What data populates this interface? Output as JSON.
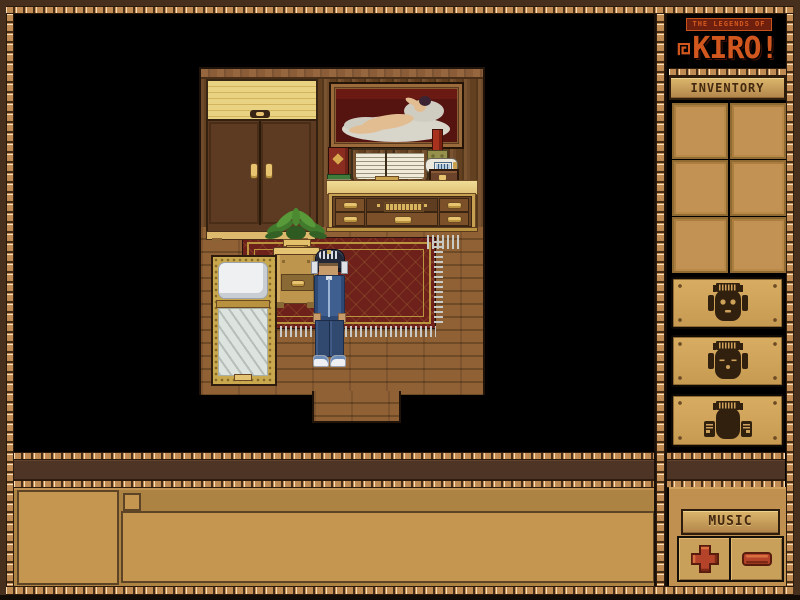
{
  "logo": {
    "tagline": "THE LEGENDS OF",
    "title": "KIRO!"
  },
  "inventory": {
    "header": "INVENTORY",
    "slot_count": 6,
    "slots": [
      "",
      "",
      "",
      "",
      "",
      ""
    ]
  },
  "emote_buttons": [
    {
      "icon": "tribal-mask-eyes-open-icon"
    },
    {
      "icon": "tribal-mask-eyes-closed-icon"
    },
    {
      "icon": "tribal-mask-fists-icon"
    }
  ],
  "music": {
    "label": "MUSIC",
    "volume_up_glyph": "plus",
    "volume_down_glyph": "minus"
  },
  "chat": {
    "portrait_value": "",
    "checkbox_checked": false,
    "input_value": ""
  },
  "scene": {
    "location": "bedroom",
    "objects": [
      "wardrobe",
      "framed-painting-reclining-figure",
      "dresser-desk",
      "open-book",
      "red-book",
      "book-stack",
      "red-candle",
      "bottle",
      "small-chest",
      "potted-fern",
      "bed",
      "nightstand",
      "red-rug",
      "doorway"
    ],
    "player": {
      "outfit": "blue tracksuit",
      "headgear": "dark striped helmet",
      "shoes": "white sneakers"
    }
  },
  "colors": {
    "frame_brown": "#46301d",
    "rope_tan": "#c08c54",
    "panel_tan": "#c9a05a",
    "accent_orange": "#d2571e",
    "button_red": "#b5432a",
    "rug_red": "#6e211b",
    "dark_band": "#4d3424",
    "slot_fill": "#c29255"
  }
}
